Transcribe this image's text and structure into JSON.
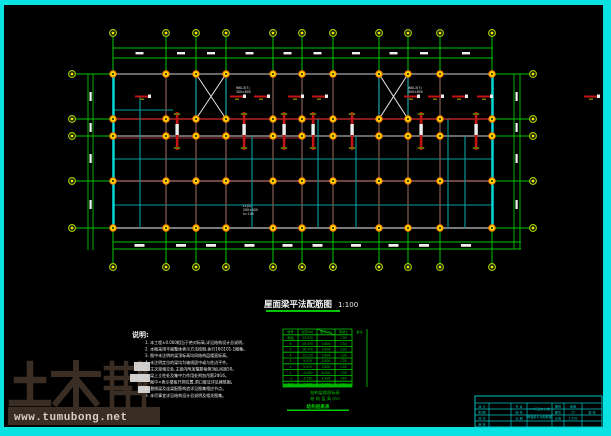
{
  "window": {
    "border_color": "#0ae2e2",
    "canvas_color": "#000000"
  },
  "plan": {
    "title": "屋面梁平法配筋图",
    "title_scale": "1:100",
    "axes": {
      "cols_x": [
        113,
        166,
        196,
        226,
        273,
        302,
        333,
        379,
        408,
        440,
        492
      ],
      "rows_y": [
        74,
        119,
        136,
        181,
        228
      ],
      "left": 113,
      "right": 493,
      "top": 74,
      "bottom": 228,
      "top_bubble_y": 33,
      "bottom_bubble_y": 267,
      "left_bubble_x": 72,
      "right_bubble_x": 533,
      "line_color": "#00c400",
      "bubble_ring": "#a8d400",
      "bubble_dot": "#ecec00"
    },
    "dims": {
      "top_lines_y": [
        48,
        58
      ],
      "bottom_lines_y": [
        242,
        249
      ],
      "left_lines_x": [
        88,
        93
      ],
      "right_lines_x": [
        514,
        520
      ],
      "tick_color": "#f0f0f0"
    },
    "edge_color": "#00dcdc",
    "h_beams": [
      {
        "y": 74,
        "x1": 113,
        "x2": 493,
        "c": "#8c8c8c",
        "w": 1.6
      },
      {
        "y": 110,
        "x1": 113,
        "x2": 173,
        "c": "#00a0a0",
        "w": 1
      },
      {
        "y": 119,
        "x1": 113,
        "x2": 493,
        "c": "#b22424",
        "w": 1.6
      },
      {
        "y": 136,
        "x1": 113,
        "x2": 493,
        "c": "#8c8c8c",
        "w": 1.4
      },
      {
        "y": 138,
        "x1": 113,
        "x2": 302,
        "c": "#9a2e2e",
        "w": 1
      },
      {
        "y": 159,
        "x1": 113,
        "x2": 493,
        "c": "#00a0a0",
        "w": 1.1
      },
      {
        "y": 181,
        "x1": 113,
        "x2": 493,
        "c": "#9b5c5c",
        "w": 1.5
      },
      {
        "y": 205,
        "x1": 113,
        "x2": 493,
        "c": "#00a0a0",
        "w": 1.1
      },
      {
        "y": 228,
        "x1": 113,
        "x2": 493,
        "c": "#8c8c8c",
        "w": 1.8
      }
    ],
    "v_cyan": [
      {
        "x": 140,
        "y1": 97,
        "y2": 228
      },
      {
        "x": 196,
        "y1": 74,
        "y2": 119
      },
      {
        "x": 226,
        "y1": 74,
        "y2": 119
      },
      {
        "x": 252,
        "y1": 136,
        "y2": 228
      },
      {
        "x": 318,
        "y1": 119,
        "y2": 228
      },
      {
        "x": 356,
        "y1": 136,
        "y2": 228
      },
      {
        "x": 379,
        "y1": 74,
        "y2": 119
      },
      {
        "x": 408,
        "y1": 74,
        "y2": 119
      },
      {
        "x": 448,
        "y1": 119,
        "y2": 228
      },
      {
        "x": 465,
        "y1": 136,
        "y2": 228
      }
    ],
    "column_color": "#7c564c",
    "column_marker": {
      "ring": "#ff8800",
      "fill": "#ffdd00",
      "hole": "#151000"
    },
    "braces": [
      {
        "x1": 196,
        "y1": 74,
        "x2": 226,
        "y2": 119
      },
      {
        "x1": 379,
        "y1": 74,
        "x2": 408,
        "y2": 119
      }
    ],
    "brace_color": "#e8e8e8",
    "red": "#c41414",
    "red_hdashes_y": 95.5,
    "red_hdashes_x": [
      135,
      230,
      254,
      288,
      312,
      404,
      428,
      452,
      477,
      584
    ],
    "red_vbars_x": [
      177,
      244,
      284,
      313,
      352,
      421,
      476
    ],
    "labels": [
      {
        "x": 236,
        "y": 89,
        "lines": [
          "WKL3(7)",
          "300×600"
        ]
      },
      {
        "x": 408,
        "y": 89,
        "lines": [
          "WKL3(7)",
          "300×600"
        ]
      },
      {
        "x": 243,
        "y": 207,
        "lines": [
          "L1(2)",
          "200×400",
          "h=100"
        ]
      }
    ]
  },
  "notes": {
    "heading": "说明:",
    "lines": [
      "本工程±0.000相当于绝对标高,详见结构设计总说明。",
      "本图采用平面整体表示方法绘制,执行16G101-1图集。",
      "图中未注明的梁顶标高均同结构层楼面标高。",
      "未注明定位的梁均为轴线居中或与柱边平齐。",
      "主次梁相交处,主梁内附加箍筋每侧3组,间距50。",
      "梁上立柱处及集中力作用处附加吊筋2Φ16。",
      "图中×表示楼板开洞位置,洞口做法详见建筑图。",
      "悬挑梁及连梁配筋构造详见图集相应节点。",
      "未尽事宜详见结构设计总说明及相关图集。"
    ]
  },
  "floor_table": {
    "x": 283,
    "y": 329,
    "width": 84,
    "row_h": 5.8,
    "col_edges": [
      283,
      298,
      317,
      335,
      352,
      367
    ],
    "headers": [
      "层号",
      "标高(m)",
      "层高(m)",
      "混凝土",
      "备注"
    ],
    "rows": [
      [
        "屋面",
        "23.970",
        "",
        "C30",
        ""
      ],
      [
        "6",
        "20.370",
        "3.600",
        "C30",
        ""
      ],
      [
        "5",
        "16.770",
        "3.600",
        "C30",
        ""
      ],
      [
        "4",
        "13.170",
        "3.600",
        "C30",
        ""
      ],
      [
        "3",
        "9.570",
        "3.600",
        "C35",
        ""
      ],
      [
        "2",
        "5.970",
        "3.600",
        "C35",
        ""
      ],
      [
        "1",
        "-0.030",
        "6.000",
        "C35",
        ""
      ],
      [
        "-1",
        "-4.530",
        "4.500",
        "C40",
        ""
      ],
      [
        "基础",
        "-6.000",
        "1.470",
        "C40",
        ""
      ]
    ],
    "color": "#00cc00",
    "footer_line1": "结构层楼面标高",
    "footer_line2": "结 构 层 高 (m)",
    "caption": "结构层高表"
  },
  "title_block": {
    "color": "#00c4c4",
    "x": 475,
    "y": 396,
    "right": 602,
    "bottom": 427,
    "left_labels": [
      "设 计",
      "制 图",
      "校 对",
      "审 核"
    ],
    "mid_labels": [
      "专 业",
      "结 构",
      "日 期",
      ""
    ],
    "center_lines": [
      "××综合办公楼",
      "屋面梁平法配筋图"
    ],
    "small_labels": [
      "图别",
      "图号",
      "比例"
    ],
    "right_cells": [
      "结施",
      "15",
      "1:100"
    ],
    "far_cell": "第 张"
  },
  "watermark": {
    "brand": "土木帮",
    "url": "www.tumubong.net",
    "glyph_color": "#3a2d23",
    "bar_color": "#3a2d23",
    "url_color": "#d8d1c5"
  }
}
